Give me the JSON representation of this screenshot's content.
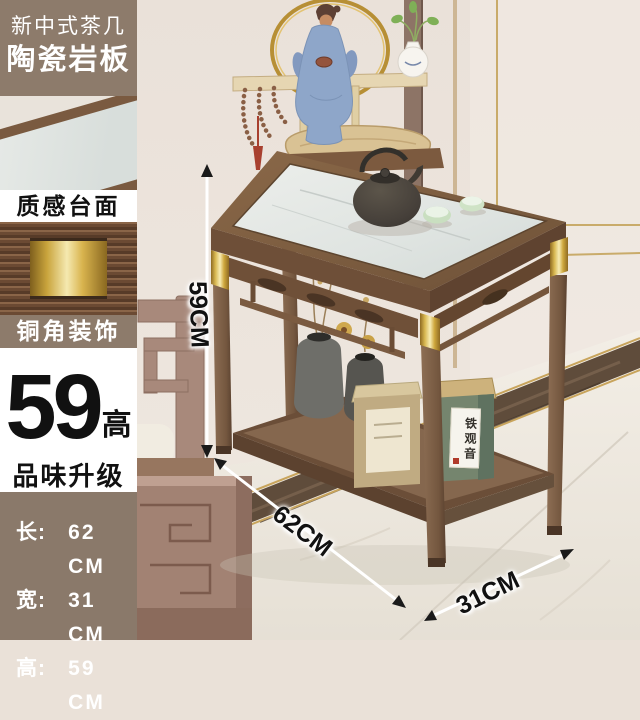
{
  "badge": {
    "line1": "新中式茶几",
    "line2": "陶瓷岩板"
  },
  "panel_labels": {
    "texture_top": "质感台面",
    "copper_corner": "铜角装饰"
  },
  "highlight": {
    "number": "59",
    "suffix": "高",
    "tagline": "品味升级"
  },
  "specs": {
    "rows": [
      {
        "label": "长:",
        "value": "62 CM"
      },
      {
        "label": "宽:",
        "value": "31 CM"
      },
      {
        "label": "高:",
        "value": "59 CM"
      }
    ]
  },
  "dimension_labels": {
    "height": "59CM",
    "length": "62CM",
    "depth": "31CM"
  },
  "product": {
    "tea_tin_label": "铁观音"
  },
  "colors": {
    "accent_brown": "#8d7b6b",
    "specs_brown": "#8a796a",
    "gold": "#d8b24a",
    "wood": "#7a5c42",
    "ceramic": "#e2e6e3",
    "wall": "#ebe2da",
    "floor": "#eee9e1"
  }
}
